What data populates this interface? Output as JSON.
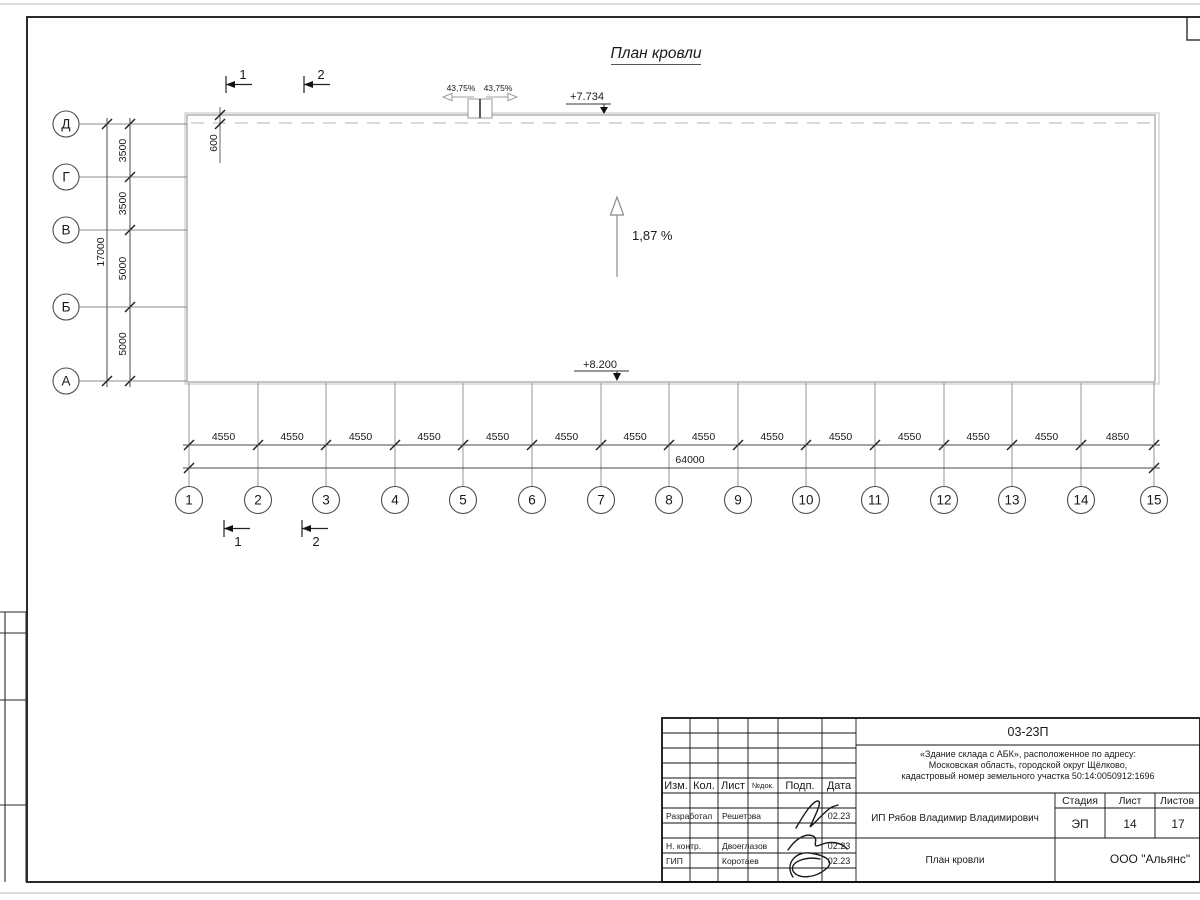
{
  "title": "План кровли",
  "colors": {
    "ink": "#1a1a1a",
    "line_gray": "#9c9c9c"
  },
  "roof": {
    "slope": "1,87 %",
    "elev_top": "+7.734",
    "elev_bottom": "+8.200",
    "parapet_slope_left": "43,75%",
    "parapet_slope_right": "43,75%",
    "edge_offset_dim": "600"
  },
  "axes": {
    "rows": [
      "Д",
      "Г",
      "В",
      "Б",
      "А"
    ],
    "row_dims": [
      "3500",
      "3500",
      "5000",
      "5000"
    ],
    "row_total": "17000",
    "cols": [
      "1",
      "2",
      "3",
      "4",
      "5",
      "6",
      "7",
      "8",
      "9",
      "10",
      "11",
      "12",
      "13",
      "14",
      "15"
    ],
    "col_dims": [
      "4550",
      "4550",
      "4550",
      "4550",
      "4550",
      "4550",
      "4550",
      "4550",
      "4550",
      "4550",
      "4550",
      "4550",
      "4550",
      "4850"
    ],
    "col_total": "64000"
  },
  "section_marks": [
    "1",
    "2"
  ],
  "stamp": {
    "doc_number": "03-23П",
    "address_lines": [
      "«Здание склада с АБК», расположенное по адресу:",
      "Московская область, городской округ Щёлково,",
      "кадастровый номер земельного участка 50:14:0050912:1696"
    ],
    "header_cells": [
      "Изм.",
      "Кол.",
      "Лист",
      "№док.",
      "Подп.",
      "Дата"
    ],
    "rows": [
      {
        "role": "Разработал",
        "name": "Решетова",
        "date": "02.23"
      },
      {
        "role": "Н. контр.",
        "name": "Двоеглазов",
        "date": "02.23"
      },
      {
        "role": "ГИП",
        "name": "Коротаев",
        "date": "02.23"
      }
    ],
    "client": "ИП Рябов Владимир Владимирович",
    "stage_label": "Стадия",
    "sheet_label": "Лист",
    "sheets_label": "Листов",
    "stage": "ЭП",
    "sheet": "14",
    "sheets": "17",
    "drawing_title": "План кровли",
    "company": "ООО \"Альянс\""
  }
}
